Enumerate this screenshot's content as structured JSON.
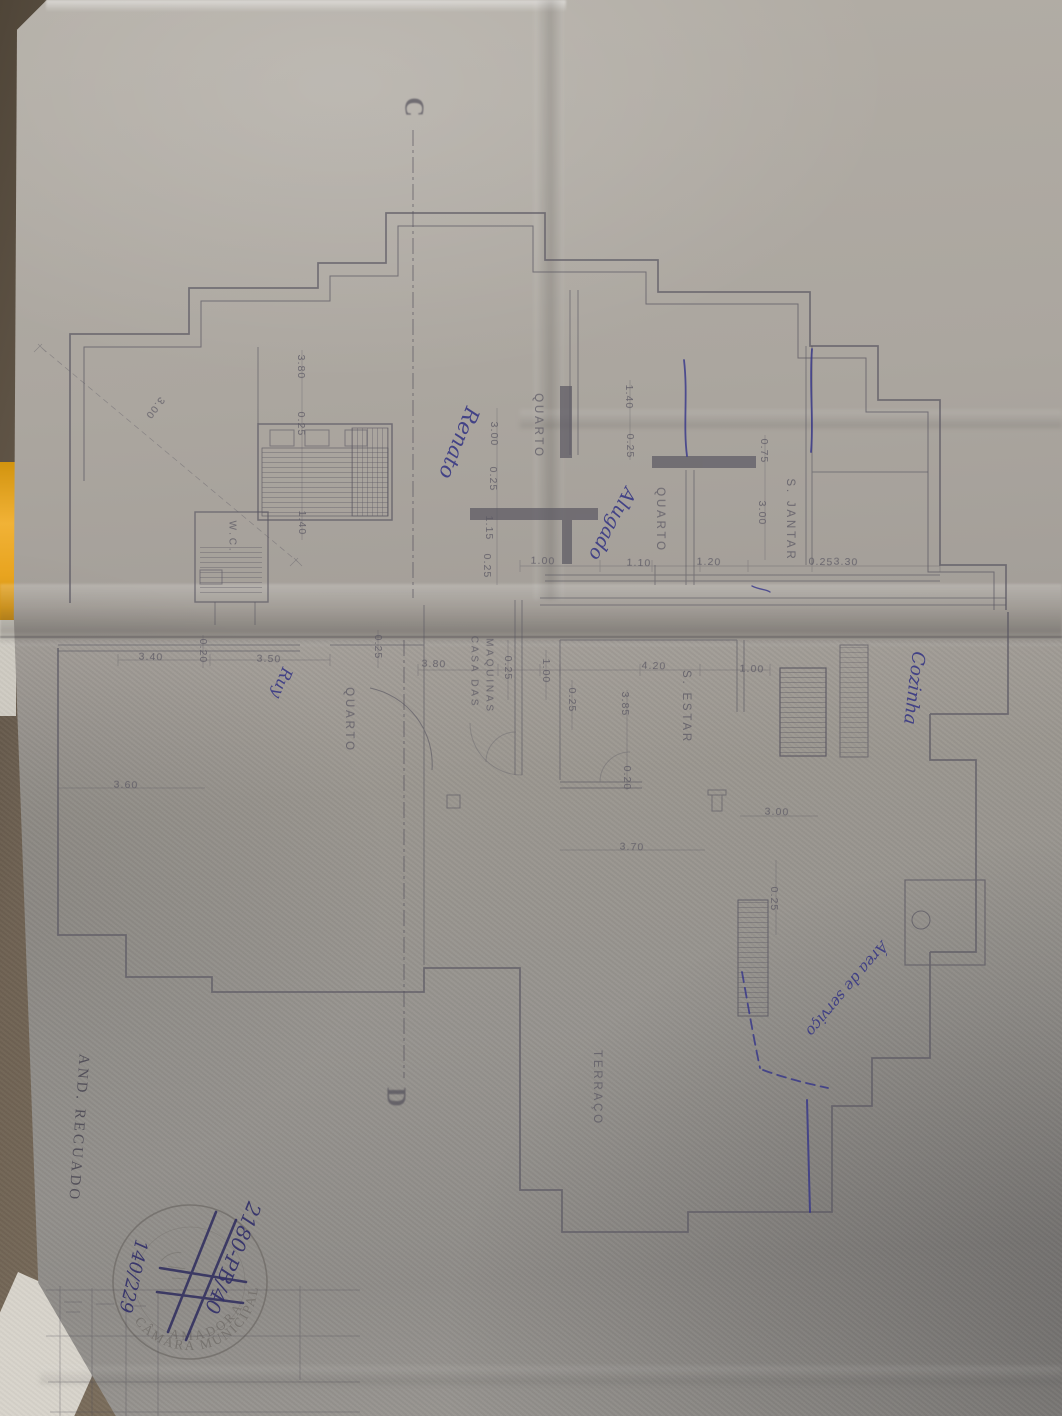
{
  "drawing": {
    "section_top": "C",
    "section_bottom": "D",
    "title_vertical": "AND. RECUADO",
    "rooms": {
      "quarto_upper": "QUARTO",
      "quarto_mid": "QUARTO",
      "quarto_lower": "QUARTO",
      "s_jantar": "S. JANTAR",
      "s_estar": "S. ESTAR",
      "wc": "W.C.",
      "casa_maquinas_line1": "CASA DAS",
      "casa_maquinas_line2": "MAQUINAS",
      "terraco": "TERRAÇO"
    },
    "dims": [
      "3.00",
      "3.80",
      "0.25",
      "3.00",
      "0.25",
      "1.15",
      "0.25",
      "1.40",
      "1.00",
      "1.10",
      "1.20",
      "0.25",
      "3.30",
      "1.40",
      "0.25",
      "0.75",
      "3.00",
      "3.40",
      "0.20",
      "3.50",
      "0.25",
      "3.80",
      "0.25",
      "1.00",
      "0.25",
      "4.20",
      "1.00",
      "3.85",
      "0.20",
      "3.70",
      "3.00",
      "0.25",
      "3.60"
    ]
  },
  "annotations": {
    "renato": "Renato",
    "alugado": "Alugado",
    "cozinha": "Cozinha",
    "ruy": "Ruy",
    "area_servico": "Área de serviço",
    "stamp_number_main": "2180-PB/40",
    "stamp_number_secondary": "140/229"
  },
  "stamp": {
    "arc_top": "CÂMARA MUNICIPAL",
    "arc_bottom": "AMADORA"
  },
  "colors": {
    "paper": "#a9a59e",
    "table": "#82745f",
    "plan_ink": "#5a5762",
    "pen_blue": "#34348a",
    "stamp_ink": "#6e6a66",
    "folder_yellow": "#e8a41f"
  }
}
